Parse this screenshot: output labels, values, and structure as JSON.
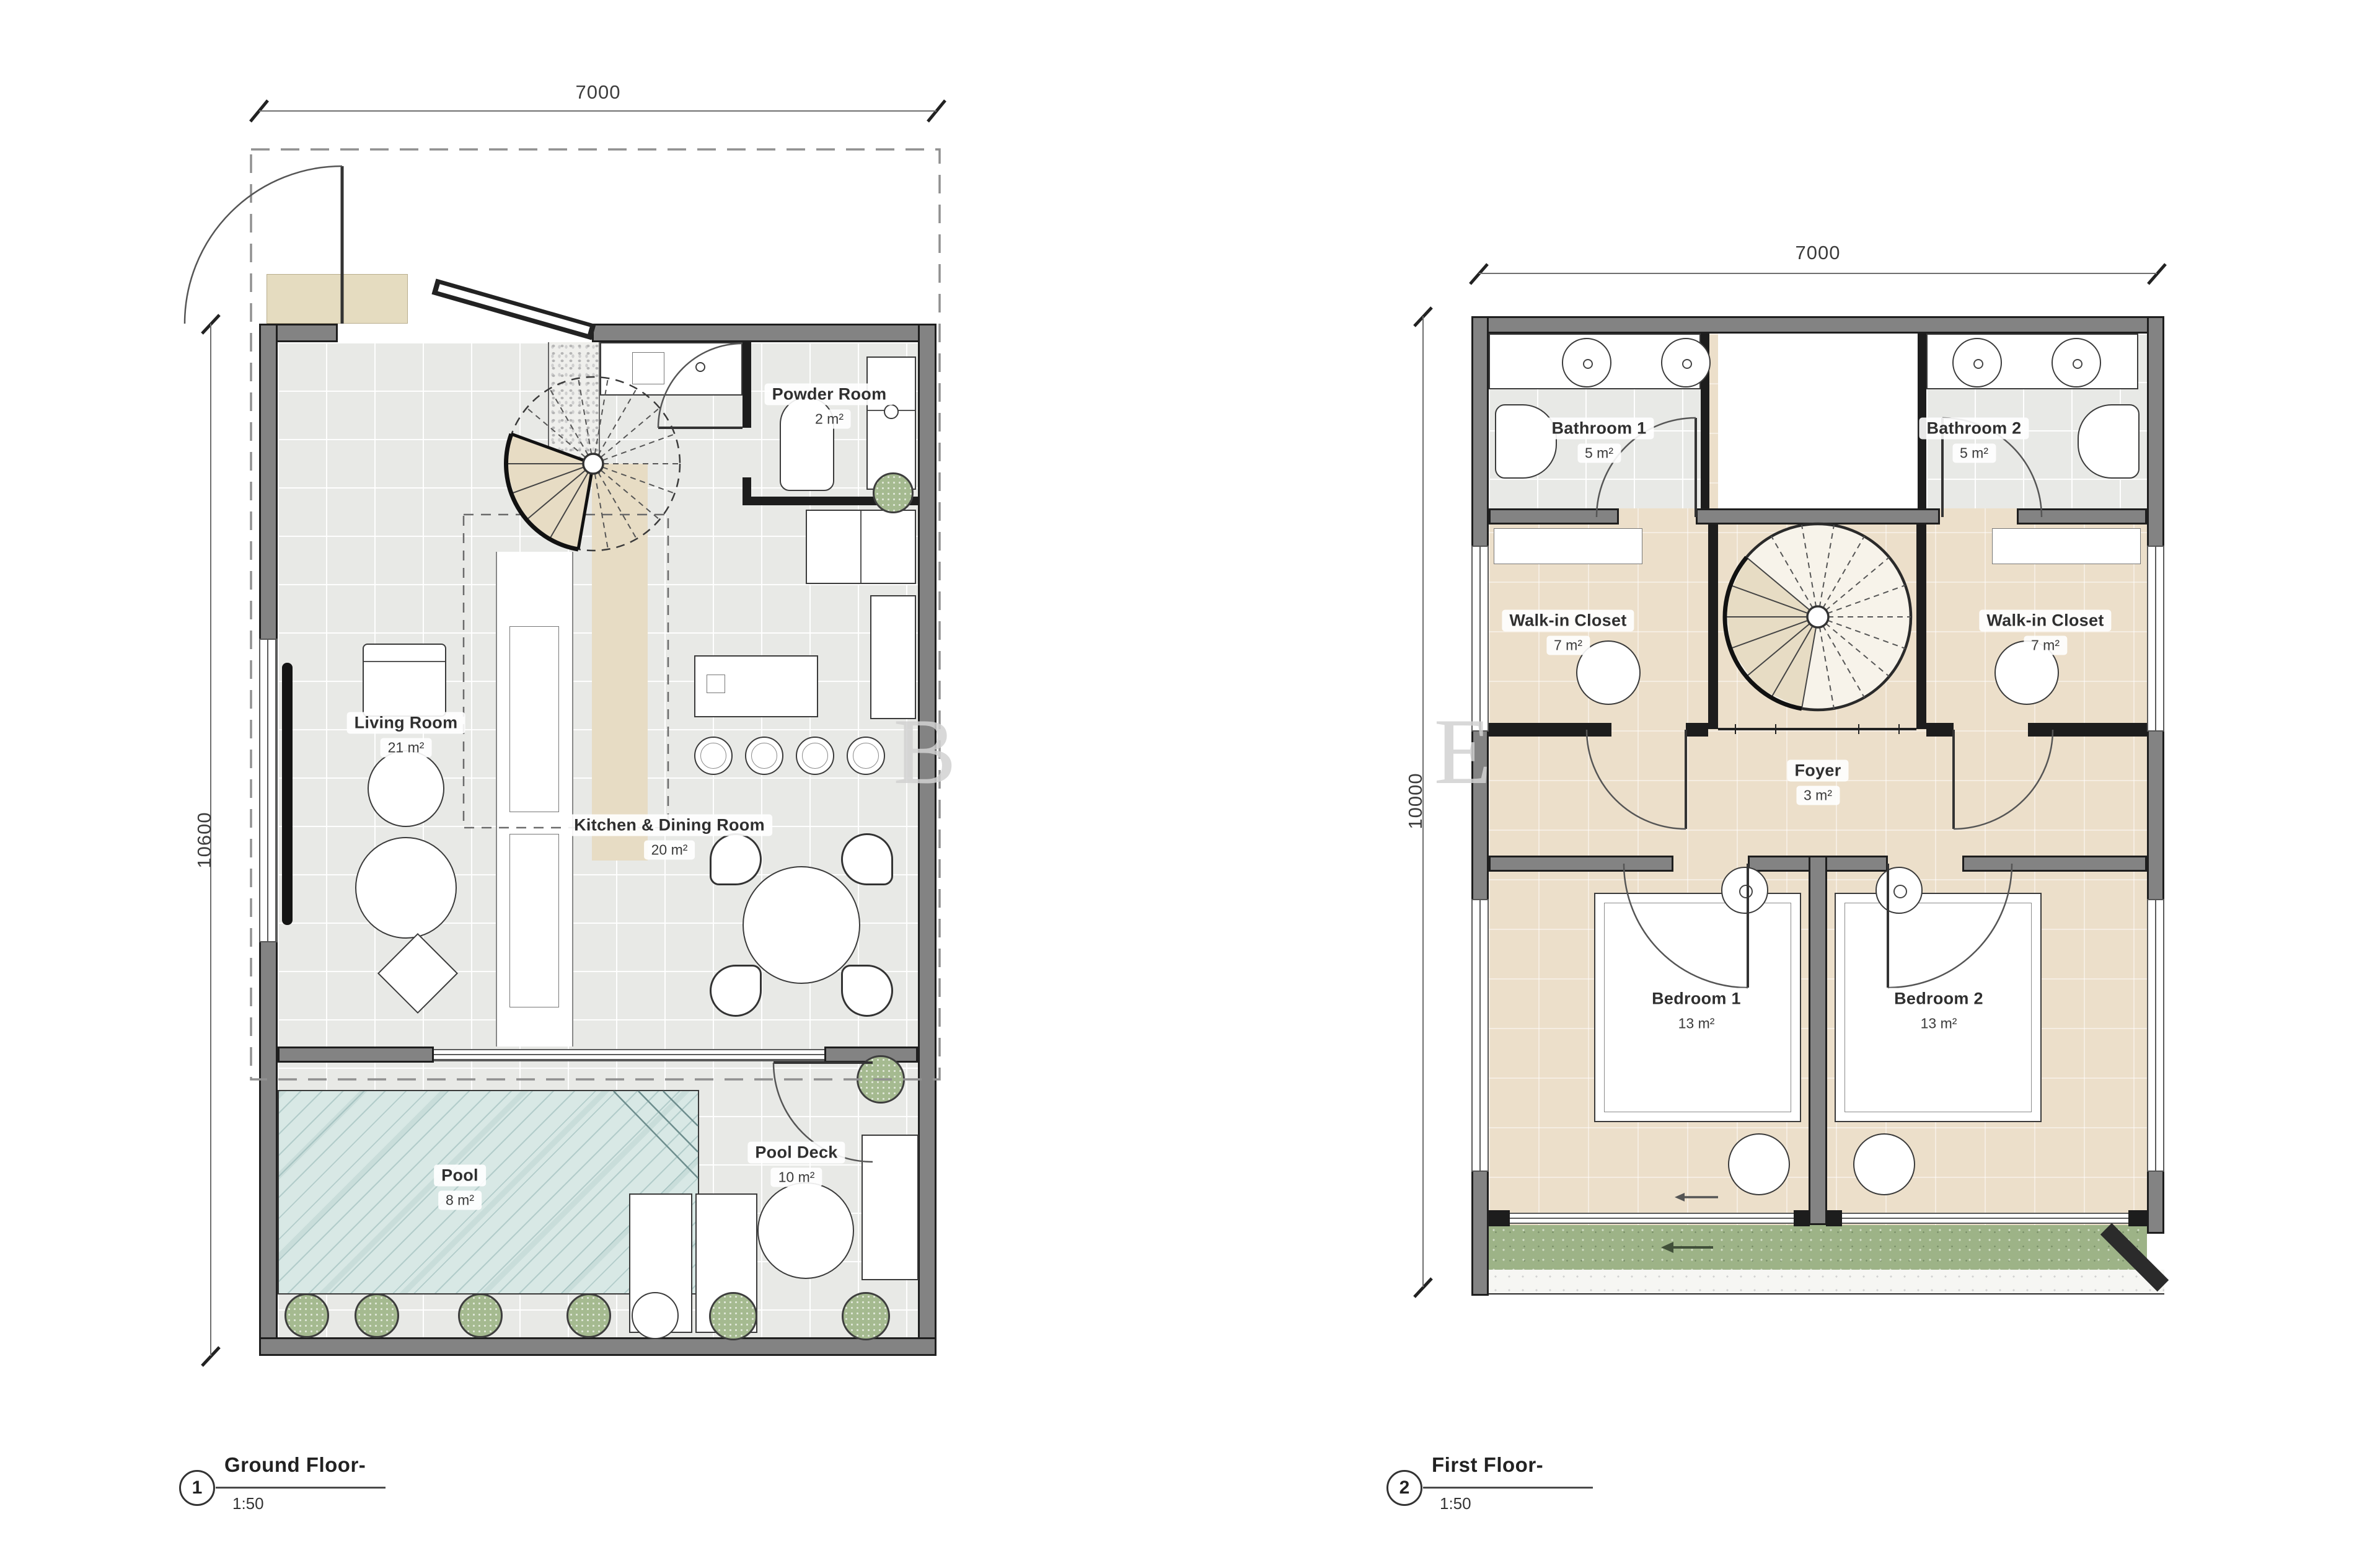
{
  "watermark": {
    "letter_b": "B",
    "letter_e": "E"
  },
  "ground_floor": {
    "callout": {
      "number": "1",
      "title": "Ground Floor-",
      "scale": "1:50"
    },
    "dims": {
      "top": "7000",
      "left": "10600"
    },
    "rooms": {
      "powder": {
        "name": "Powder Room",
        "area": "2 m²"
      },
      "living": {
        "name": "Living Room",
        "area": "21 m²"
      },
      "kitchen": {
        "name": "Kitchen & Dining Room",
        "area": "20 m²"
      },
      "pool": {
        "name": "Pool",
        "area": "8 m²"
      },
      "pool_deck": {
        "name": "Pool Deck",
        "area": "10 m²"
      }
    }
  },
  "first_floor": {
    "callout": {
      "number": "2",
      "title": "First Floor-",
      "scale": "1:50"
    },
    "dims": {
      "top": "7000",
      "left": "10000"
    },
    "rooms": {
      "bathroom1": {
        "name": "Bathroom 1",
        "area": "5 m²"
      },
      "bathroom2": {
        "name": "Bathroom 2",
        "area": "5 m²"
      },
      "closet_left": {
        "name": "Walk-in Closet",
        "area": "7 m²"
      },
      "closet_right": {
        "name": "Walk-in Closet",
        "area": "7 m²"
      },
      "foyer": {
        "name": "Foyer",
        "area": "3 m²"
      },
      "bedroom1": {
        "name": "Bedroom 1",
        "area": "13 m²"
      },
      "bedroom2": {
        "name": "Bedroom 2",
        "area": "13 m²"
      }
    }
  },
  "colors": {
    "wall": "#838383",
    "wall_edge": "#1e1e1e",
    "floor_gray": "#e8e9e6",
    "floor_beige": "#ecdfca",
    "pool": "#d8e8e5",
    "turf": "#9db387",
    "accent_beige": "#e7dcc4",
    "watermark": "#d2d2d2"
  }
}
